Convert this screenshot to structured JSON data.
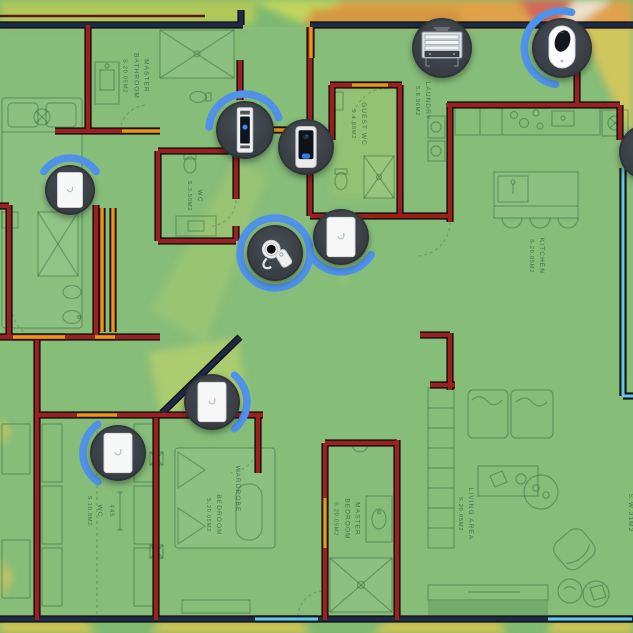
{
  "palette": {
    "signal_strong": "#7fb971",
    "signal_good": "#b6ca58",
    "signal_lime": "#cdd95b",
    "signal_yellow": "#ddc44f",
    "signal_fair": "#e2a047",
    "signal_fair_dark": "#d3963f",
    "signal_weak": "#d4625c",
    "signal_none": "#efe6d6",
    "wall_exterior": "#1c2b4a",
    "wall_interior": "#9c2020",
    "wall_door": "#ef9415",
    "wall_window": "#5fc9f2",
    "device_bg": "#3a4046",
    "device_ring": "#4f92e8",
    "plan_ink": "#1d5134"
  },
  "floorplan": {
    "rooms": [
      {
        "name": "MASTER BATHROOM",
        "area": "S.20.05m2",
        "x": 136,
        "y": 76
      },
      {
        "name": "WC",
        "area": "S.3.50m2",
        "x": 195,
        "y": 196
      },
      {
        "name": "GUEST WC",
        "area": "S.4.08m2",
        "x": 359,
        "y": 124
      },
      {
        "name": "LAUNDRY",
        "area": "S.6.96m2",
        "x": 423,
        "y": 101
      },
      {
        "name": "KITCHEN",
        "area": "S.20.05m2",
        "x": 537,
        "y": 256
      },
      {
        "name": "WC",
        "area": "S.10.8m2",
        "x": 95,
        "y": 511
      },
      {
        "name": "BEDROOM",
        "area": "S.20.05m2",
        "x": 214,
        "y": 515
      },
      {
        "name": "WARDROBE",
        "area": "",
        "x": 237,
        "y": 489
      },
      {
        "name": "MASTER BEDROOM",
        "area": "S.20.05m2",
        "x": 347,
        "y": 519
      },
      {
        "name": "LIVING AREA",
        "area": "S.20.05m2",
        "x": 466,
        "y": 514
      },
      {
        "name": "S.W.31m2",
        "area": "",
        "x": 630,
        "y": 513
      }
    ],
    "dimensions": [
      {
        "text": "445",
        "x": 111,
        "y": 511
      }
    ]
  },
  "devices": [
    {
      "id": "inwall-ap-master-bath",
      "type": "inwall-ap",
      "x": 70,
      "y": 190,
      "r": 25,
      "ring": {
        "kind": "arc",
        "start": 215,
        "end": 325
      }
    },
    {
      "id": "access-reader-hall",
      "type": "access-reader",
      "x": 245,
      "y": 130,
      "r": 29,
      "ring": {
        "kind": "arc",
        "start": 185,
        "end": 340
      }
    },
    {
      "id": "doorbell-entry",
      "type": "doorbell",
      "x": 306,
      "y": 147,
      "r": 28,
      "ring": {
        "kind": "none"
      }
    },
    {
      "id": "equipment-rack",
      "type": "rack",
      "x": 442,
      "y": 48,
      "r": 30,
      "ring": {
        "kind": "none"
      }
    },
    {
      "id": "camera-laundry",
      "type": "camera",
      "x": 562,
      "y": 48,
      "r": 30,
      "ring": {
        "kind": "arc",
        "start": 100,
        "end": 285
      }
    },
    {
      "id": "key-fob-reader",
      "type": "key-fob",
      "x": 275,
      "y": 253,
      "r": 28,
      "ring": {
        "kind": "full"
      }
    },
    {
      "id": "inwall-ap-hall",
      "type": "inwall-ap",
      "x": 341,
      "y": 237,
      "r": 28,
      "ring": {
        "kind": "arc",
        "start": 30,
        "end": 150
      }
    },
    {
      "id": "inwall-ap-corridor",
      "type": "inwall-ap",
      "x": 212,
      "y": 402,
      "r": 28,
      "ring": {
        "kind": "arc",
        "start": 310,
        "end": 410
      }
    },
    {
      "id": "inwall-ap-bedroom",
      "type": "inwall-ap",
      "x": 118,
      "y": 453,
      "r": 28,
      "ring": {
        "kind": "arc",
        "start": 125,
        "end": 235
      }
    },
    {
      "id": "device-right-edge",
      "type": "blank",
      "x": 647,
      "y": 152,
      "r": 28,
      "ring": {
        "kind": "none"
      }
    }
  ]
}
